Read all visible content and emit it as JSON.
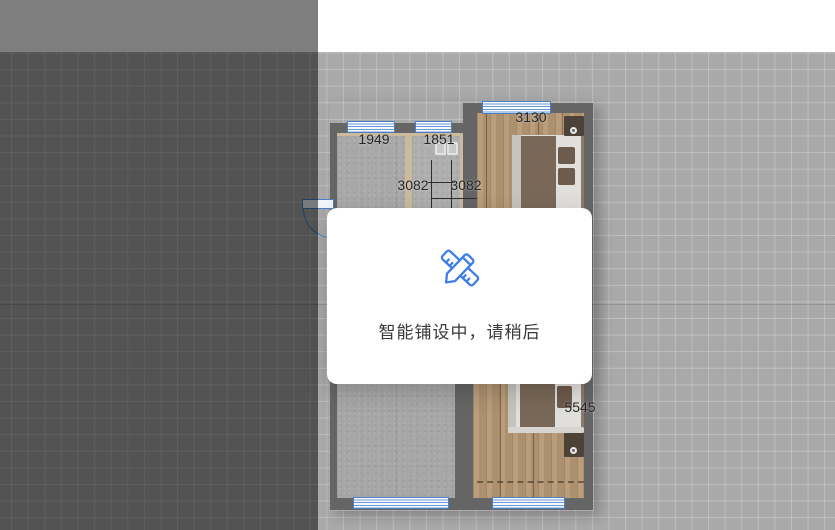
{
  "modal": {
    "message": "智能铺设中，请稍后",
    "icon": "pencil-ruler-icon",
    "accent_color": "#3D7EE8"
  },
  "floor_plan": {
    "dimension_labels": [
      {
        "id": "room-top-left-width",
        "value": "1949"
      },
      {
        "id": "room-top-mid-width",
        "value": "1851"
      },
      {
        "id": "bedroom-top-width",
        "value": "3130"
      },
      {
        "id": "mid-span-left",
        "value": "3082"
      },
      {
        "id": "mid-span-right",
        "value": "3082"
      },
      {
        "id": "bedroom-bottom-depth",
        "value": "5545"
      }
    ],
    "colors": {
      "wall": "#656565",
      "wood_floor": "#B49672",
      "concrete_floor": "#A8A8A8",
      "window_blue": "#4A80C4",
      "canvas_grid": "#A9A9A9"
    }
  }
}
